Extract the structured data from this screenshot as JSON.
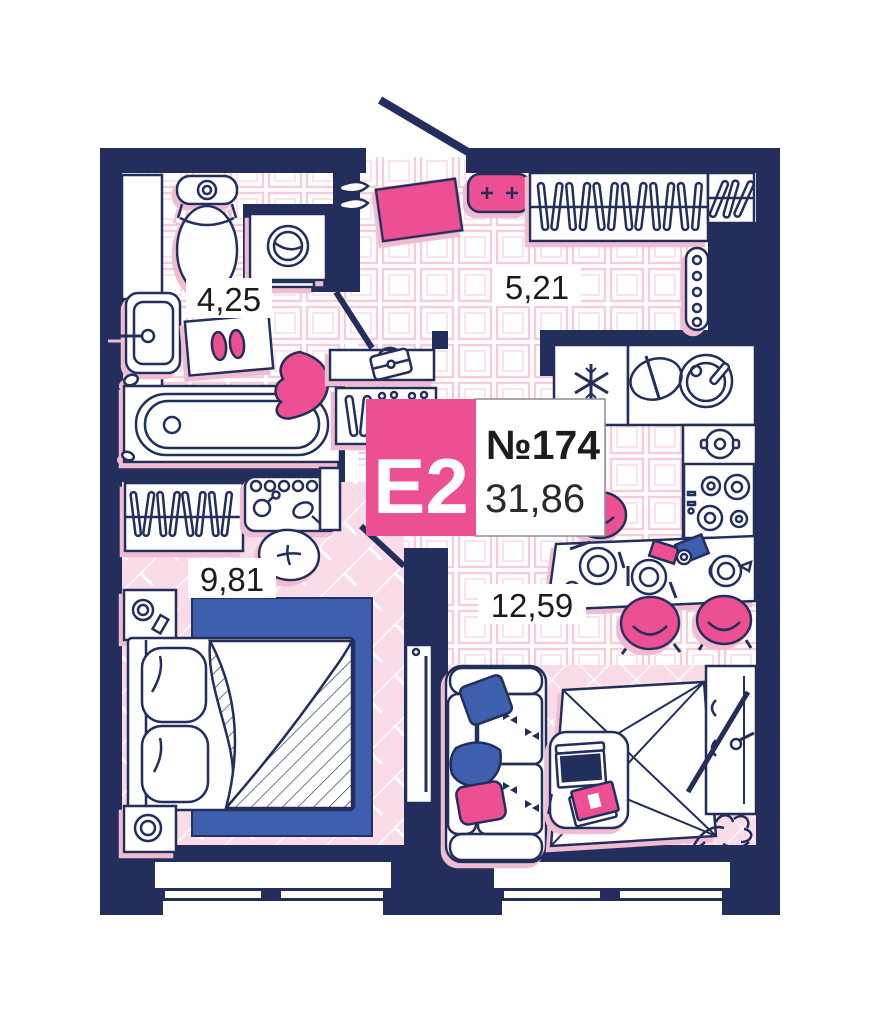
{
  "unit_card": {
    "type_label": "Е2",
    "number": "№174",
    "total_area": "31,86"
  },
  "rooms": [
    {
      "name": "bathroom",
      "area": "4,25"
    },
    {
      "name": "hallway",
      "area": "5,21"
    },
    {
      "name": "bedroom",
      "area": "9,81"
    },
    {
      "name": "kitchen-living-room",
      "area": "12,59"
    }
  ],
  "colors": {
    "wall_navy": "#242e5c",
    "accent_pink": "#ec4f92",
    "accent_blue": "#3e5fae",
    "floor_pink": "#fadce8",
    "tile_line_pink": "#f6ccd9"
  }
}
